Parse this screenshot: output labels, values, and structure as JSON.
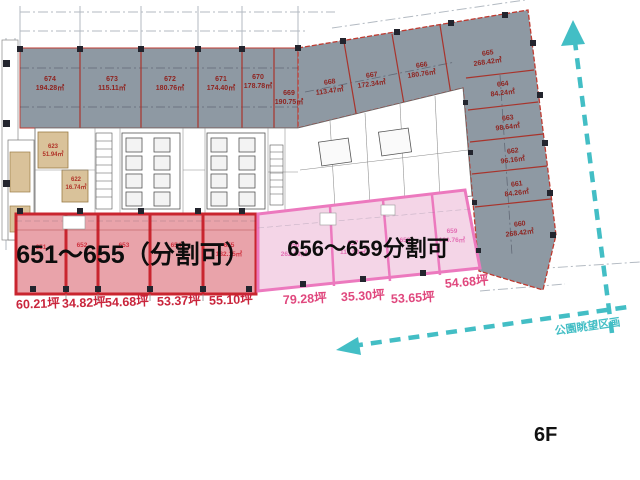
{
  "floor": {
    "label": "6F"
  },
  "annotations": {
    "park_view": "公園眺望区画"
  },
  "red_zone": {
    "title": "651～655（分割可）",
    "rooms": [
      {
        "id": "651",
        "tsubo": "60.21坪"
      },
      {
        "id": "652",
        "tsubo": "34.82坪"
      },
      {
        "id": "653",
        "tsubo": "54.68坪"
      },
      {
        "id": "654",
        "tsubo": "53.37坪"
      },
      {
        "id": "655",
        "area": "182.15㎡",
        "tsubo": "55.10坪"
      }
    ]
  },
  "pink_zone": {
    "title": "656～659分割可",
    "rooms": [
      {
        "id": "656",
        "area": "262.09㎡",
        "tsubo": "79.28坪"
      },
      {
        "id": "657",
        "area": "116.90㎡",
        "tsubo": "35.30坪"
      },
      {
        "id": "658",
        "tsubo": "53.65坪"
      },
      {
        "id": "659",
        "area": "180.76㎡",
        "tsubo": "54.68坪"
      }
    ]
  },
  "gray_zone": {
    "rooms": [
      {
        "id": "674",
        "area": "194.28㎡"
      },
      {
        "id": "673",
        "area": "115.11㎡"
      },
      {
        "id": "672",
        "area": "180.76㎡"
      },
      {
        "id": "671",
        "area": "174.40㎡"
      },
      {
        "id": "670",
        "area": "178.78㎡"
      },
      {
        "id": "669",
        "area": "190.75㎡"
      },
      {
        "id": "668",
        "area": "113.47㎡"
      },
      {
        "id": "667",
        "area": "172.34㎡"
      },
      {
        "id": "666",
        "area": "180.76㎡"
      },
      {
        "id": "665",
        "area": "268.42㎡"
      },
      {
        "id": "664",
        "area": "84.24㎡"
      },
      {
        "id": "663",
        "area": "98.64㎡"
      },
      {
        "id": "662",
        "area": "96.16㎡"
      },
      {
        "id": "661",
        "area": "84.26㎡"
      },
      {
        "id": "660",
        "area": "268.42㎡"
      }
    ]
  },
  "core": {
    "rooms": [
      {
        "id": "623",
        "area": "51.94㎡"
      },
      {
        "id": "622",
        "area": "16.74㎡"
      }
    ]
  },
  "colors": {
    "teal": "#43bec5",
    "red_accent": "#c9252f",
    "pink_accent": "#ec79be",
    "gray_fill": "#8e99a3"
  }
}
